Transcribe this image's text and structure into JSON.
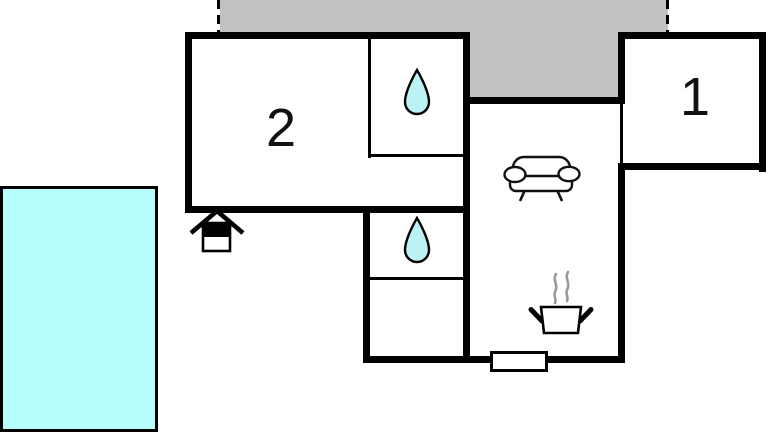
{
  "plan_type": "holiday-home-floor-plan",
  "rooms": [
    {
      "id": "room-1",
      "label": "1"
    },
    {
      "id": "room-2",
      "label": "2"
    }
  ],
  "areas": [
    {
      "name": "terrace",
      "style": "gray-hatched-boundary"
    },
    {
      "name": "swimming-pool",
      "style": "water"
    },
    {
      "name": "bathroom-top",
      "icon": "water-drop-icon"
    },
    {
      "name": "bathroom-bottom",
      "icon": "water-drop-icon"
    },
    {
      "name": "living-room",
      "icon": "sofa-icon"
    },
    {
      "name": "kitchen",
      "icon": "cooking-pot-icon"
    },
    {
      "name": "entrance",
      "icon": "entrance-house-icon"
    },
    {
      "name": "door-step",
      "icon": "door-step-marker"
    }
  ],
  "colors": {
    "terrace": "#C2C2C2",
    "pool": "#B8FDFD",
    "drop": "#BCF2F4",
    "wall": "#000000",
    "steam": "#999999",
    "background": "#FFFFFF"
  }
}
